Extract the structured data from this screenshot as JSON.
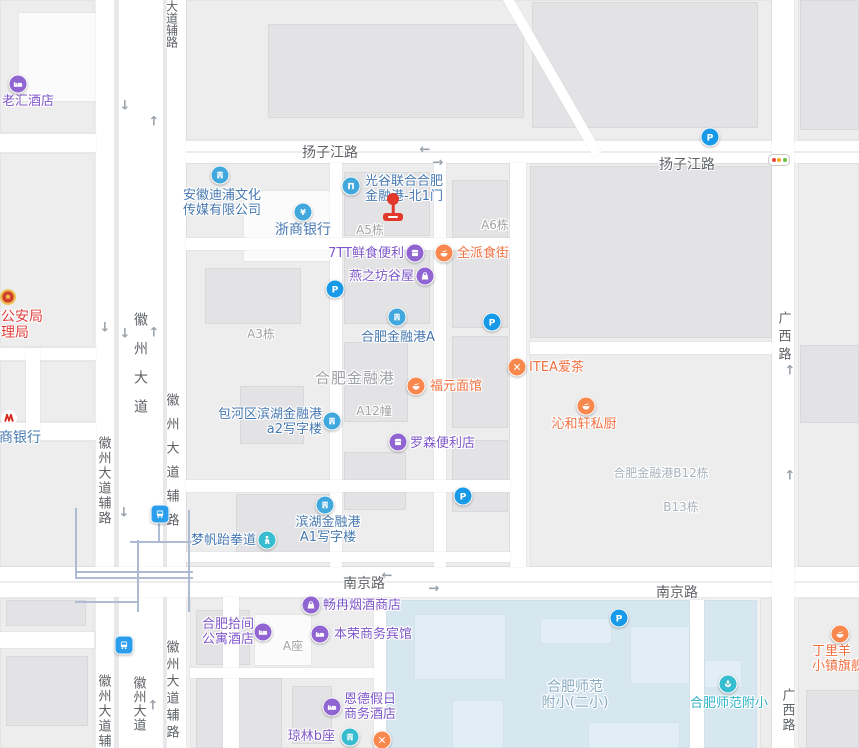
{
  "canvas": {
    "width": 859,
    "height": 748
  },
  "palette": {
    "purple": "#7e57c8",
    "purpleIcon": "#9065d2",
    "blue": "#4678b0",
    "blueIcon": "#41a8dd",
    "orange": "#ef7041",
    "orangeIcon": "#f8884e",
    "teal": "#2fb3c5",
    "tealIcon": "#38bccf",
    "red": "#e23d3c",
    "schoolarea": "#86aabf",
    "grayLabel": "#a2a2a4",
    "grayBig": "#9da0a4",
    "grayBlue": "#a9b1ba",
    "roadLabel": "#5f6266",
    "pIcon": "#199ae8",
    "busIcon": "#2a9ded",
    "marker": "#e2372b",
    "metro": "#aebcd3"
  },
  "road_labels": [
    {
      "text": "扬子江路",
      "x": 330,
      "y": 142
    },
    {
      "text": "扬子江路",
      "x": 687,
      "y": 154
    },
    {
      "text": "南京路",
      "x": 364,
      "y": 573
    },
    {
      "text": "南京路",
      "x": 677,
      "y": 582
    },
    {
      "text": "大道辅路",
      "x": 172,
      "y": 0,
      "v": 1,
      "size": 12,
      "spacing": 0
    },
    {
      "text": "徽州大道",
      "x": 140,
      "y": 312,
      "v": 1,
      "size": 14,
      "spacing": 15
    },
    {
      "text": "徽州大道辅路",
      "x": 171,
      "y": 393,
      "v": 1,
      "size": 13,
      "spacing": 11
    },
    {
      "text": "徽州大道辅路",
      "x": 103,
      "y": 436,
      "v": 1,
      "size": 13,
      "spacing": 2
    },
    {
      "text": "广西路",
      "x": 783,
      "y": 311,
      "v": 1,
      "size": 13,
      "spacing": 5
    },
    {
      "text": "广西路",
      "x": 787,
      "y": 688,
      "v": 1,
      "size": 13,
      "spacing": 2
    },
    {
      "text": "徽州大道辅路",
      "x": 103,
      "y": 674,
      "v": 1,
      "size": 13,
      "spacing": 2
    },
    {
      "text": "徽州大道",
      "x": 138,
      "y": 676,
      "v": 1,
      "size": 13,
      "spacing": 1
    },
    {
      "text": "徽州大道辅路",
      "x": 171,
      "y": 640,
      "v": 1,
      "size": 13,
      "spacing": 4
    }
  ],
  "area_labels": [
    {
      "text": "A5栋",
      "x": 370,
      "y": 221,
      "size": 12,
      "color": "grayLabel"
    },
    {
      "text": "A6栋",
      "x": 495,
      "y": 216,
      "size": 12,
      "color": "grayLabel"
    },
    {
      "text": "A3栋",
      "x": 261,
      "y": 325,
      "size": 12,
      "color": "grayLabel"
    },
    {
      "text": "A12幢",
      "x": 374,
      "y": 402,
      "size": 12,
      "color": "grayLabel"
    },
    {
      "text": "合肥金融港",
      "x": 355,
      "y": 367,
      "size": 15,
      "color": "grayBig",
      "ls": 1
    },
    {
      "text": "合肥金融港B12栋",
      "x": 661,
      "y": 464,
      "size": 12,
      "color": "grayBlue"
    },
    {
      "text": "B13栋",
      "x": 681,
      "y": 498,
      "size": 12,
      "color": "grayBlue"
    },
    {
      "text": "A座",
      "x": 293,
      "y": 637,
      "size": 12,
      "color": "grayLabel"
    }
  ],
  "pois": [
    {
      "slug": "laohui-hotel",
      "icon": {
        "type": "bed",
        "color": "purpleIcon",
        "x": 18,
        "y": 84
      },
      "label": {
        "lines": [
          "老汇酒店"
        ],
        "x": 2,
        "y": 94,
        "align": "left",
        "color": "purple",
        "size": 13
      }
    },
    {
      "slug": "police-bureau",
      "icon": {
        "type": "emblem",
        "color": "",
        "x": 8,
        "y": 297
      },
      "label": {
        "lines": [
          "市公安局",
          "管理局"
        ],
        "x": -13,
        "y": 309,
        "align": "left",
        "color": "red",
        "size": 14
      }
    },
    {
      "slug": "zhaoshang-bank",
      "icon": {
        "type": "mlogo",
        "color": "",
        "x": 9,
        "y": 418
      },
      "label": {
        "lines": [
          "商银行"
        ],
        "x": -1,
        "y": 430,
        "align": "left",
        "color": "blue",
        "size": 14
      }
    },
    {
      "slug": "anhui-dipu-media",
      "icon": {
        "type": "building",
        "color": "blueIcon",
        "x": 220,
        "y": 175
      },
      "label": {
        "lines": [
          "安徽迪浦文化",
          "传媒有限公司"
        ],
        "x": 222,
        "y": 188,
        "align": "center",
        "color": "blue",
        "size": 13
      }
    },
    {
      "slug": "zheshang-bank",
      "icon": {
        "type": "yen",
        "color": "blueIcon",
        "x": 303,
        "y": 212
      },
      "label": {
        "lines": [
          "浙商银行"
        ],
        "x": 303,
        "y": 222,
        "align": "center",
        "color": "blue",
        "size": 14
      }
    },
    {
      "slug": "guanggu-north-gate-1",
      "icon": {
        "type": "door",
        "color": "blueIcon",
        "x": 351,
        "y": 186
      },
      "label": {
        "lines": [
          "光谷联合合肥",
          "金融港-北1门"
        ],
        "x": 365,
        "y": 174,
        "align": "left",
        "color": "blue",
        "size": 13
      }
    },
    {
      "slug": "7tt-fresh-food",
      "icon": {
        "type": "store",
        "color": "purpleIcon",
        "x": 415,
        "y": 253
      },
      "label": {
        "lines": [
          "7TT鲜食便利"
        ],
        "x": 404,
        "y": 246,
        "align": "right",
        "color": "purple",
        "size": 13
      }
    },
    {
      "slug": "quanpai-food-street",
      "icon": {
        "type": "bowl",
        "color": "orangeIcon",
        "x": 444,
        "y": 253
      },
      "label": {
        "lines": [
          "全派食街"
        ],
        "x": 457,
        "y": 246,
        "align": "left",
        "color": "orange",
        "size": 13
      }
    },
    {
      "slug": "yanzhifang-guwu",
      "icon": {
        "type": "bag",
        "color": "purpleIcon",
        "x": 425,
        "y": 276
      },
      "label": {
        "lines": [
          "燕之坊谷屋"
        ],
        "x": 414,
        "y": 269,
        "align": "right",
        "color": "purple",
        "size": 13
      }
    },
    {
      "slug": "hefei-jinronggang-a",
      "icon": {
        "type": "building",
        "color": "blueIcon",
        "x": 397,
        "y": 317
      },
      "label": {
        "lines": [
          "合肥金融港A"
        ],
        "x": 398,
        "y": 330,
        "align": "center",
        "color": "blue",
        "size": 13
      }
    },
    {
      "slug": "fuyuan-noodle",
      "icon": {
        "type": "bowl",
        "color": "orangeIcon",
        "x": 416,
        "y": 386
      },
      "label": {
        "lines": [
          "福元面馆"
        ],
        "x": 430,
        "y": 379,
        "align": "left",
        "color": "orange",
        "size": 13
      }
    },
    {
      "slug": "itea-tea",
      "icon": {
        "type": "forkknife",
        "color": "orangeIcon",
        "x": 517,
        "y": 367
      },
      "label": {
        "lines": [
          "ITEA爱茶"
        ],
        "x": 529,
        "y": 360,
        "align": "left",
        "color": "orange",
        "size": 13
      }
    },
    {
      "slug": "qinhexuan-kitchen",
      "icon": {
        "type": "bowl",
        "color": "orangeIcon",
        "x": 586,
        "y": 406
      },
      "label": {
        "lines": [
          "沁和轩私厨"
        ],
        "x": 584,
        "y": 417,
        "align": "center",
        "color": "orange",
        "size": 13
      }
    },
    {
      "slug": "lawson-store",
      "icon": {
        "type": "store",
        "color": "purpleIcon",
        "x": 398,
        "y": 442
      },
      "label": {
        "lines": [
          "罗森便利店"
        ],
        "x": 410,
        "y": 436,
        "align": "left",
        "color": "purple",
        "size": 13
      }
    },
    {
      "slug": "a2-office-tower",
      "icon": {
        "type": "building",
        "color": "blueIcon",
        "x": 332,
        "y": 421
      },
      "label": {
        "lines": [
          "包河区滨湖金融港",
          "a2写字楼"
        ],
        "x": 322,
        "y": 407,
        "align": "right",
        "color": "blue",
        "size": 13
      }
    },
    {
      "slug": "a1-office-tower",
      "icon": {
        "type": "building",
        "color": "blueIcon",
        "x": 325,
        "y": 505
      },
      "label": {
        "lines": [
          "滨湖金融港",
          "A1写字楼"
        ],
        "x": 328,
        "y": 515,
        "align": "center",
        "color": "blue",
        "size": 13
      }
    },
    {
      "slug": "mengfan-taekwondo",
      "icon": {
        "type": "person",
        "color": "tealIcon",
        "x": 267,
        "y": 540
      },
      "label": {
        "lines": [
          "梦帆跆拳道"
        ],
        "x": 256,
        "y": 533,
        "align": "right",
        "color": "blue",
        "size": 13
      }
    },
    {
      "slug": "changran-tobacco-shop",
      "icon": {
        "type": "bag",
        "color": "purpleIcon",
        "x": 311,
        "y": 605
      },
      "label": {
        "lines": [
          "畅冉烟酒商店"
        ],
        "x": 323,
        "y": 598,
        "align": "left",
        "color": "purple",
        "size": 13
      }
    },
    {
      "slug": "hefei-shijian-apartment-hotel",
      "icon": {
        "type": "bed",
        "color": "purpleIcon",
        "x": 263,
        "y": 632
      },
      "label": {
        "lines": [
          "合肥拾间",
          "公寓酒店"
        ],
        "x": 254,
        "y": 617,
        "align": "right",
        "color": "purple",
        "size": 13
      }
    },
    {
      "slug": "benrong-business-hotel",
      "icon": {
        "type": "bed",
        "color": "purpleIcon",
        "x": 320,
        "y": 634
      },
      "label": {
        "lines": [
          "本荣商务宾馆"
        ],
        "x": 334,
        "y": 627,
        "align": "left",
        "color": "purple",
        "size": 13
      }
    },
    {
      "slug": "ende-holiday-hotel",
      "icon": {
        "type": "bed",
        "color": "purpleIcon",
        "x": 332,
        "y": 707
      },
      "label": {
        "lines": [
          "恩德假日",
          "商务酒店"
        ],
        "x": 344,
        "y": 692,
        "align": "left",
        "color": "purple",
        "size": 13
      }
    },
    {
      "slug": "qionglin-block-b",
      "icon": {
        "type": "building",
        "color": "tealIcon",
        "x": 350,
        "y": 737
      },
      "label": {
        "lines": [
          "琼林b座"
        ],
        "x": 335,
        "y": 729,
        "align": "right",
        "color": "purple",
        "size": 13
      }
    },
    {
      "slug": "restaurant-unnamed",
      "icon": {
        "type": "forkknife",
        "color": "orangeIcon",
        "x": 382,
        "y": 740
      },
      "label": null
    },
    {
      "slug": "shifan-fuxiao-ersiao-area",
      "icon": null,
      "label": {
        "lines": [
          "合肥师范",
          "附小(二小)"
        ],
        "x": 575,
        "y": 679,
        "align": "center",
        "color": "schoolarea",
        "size": 14
      }
    },
    {
      "slug": "hefei-shifan-fuxiao",
      "icon": {
        "type": "leaf",
        "color": "tealIcon",
        "x": 728,
        "y": 684
      },
      "label": {
        "lines": [
          "合肥师范附小"
        ],
        "x": 729,
        "y": 696,
        "align": "center",
        "color": "teal",
        "size": 13
      }
    },
    {
      "slug": "dingliyang-flagship",
      "icon": {
        "type": "bowl",
        "color": "orangeIcon",
        "x": 840,
        "y": 634
      },
      "label": {
        "lines": [
          "丁里羊",
          "小镇旗舰"
        ],
        "x": 812,
        "y": 644,
        "align": "left",
        "color": "orange",
        "size": 13
      }
    }
  ],
  "badges": {
    "parking": [
      {
        "x": 710,
        "y": 137
      },
      {
        "x": 335,
        "y": 289
      },
      {
        "x": 492,
        "y": 322
      },
      {
        "x": 463,
        "y": 496
      },
      {
        "x": 619,
        "y": 618
      }
    ],
    "bus": [
      {
        "x": 160,
        "y": 514
      },
      {
        "x": 124,
        "y": 645
      }
    ]
  },
  "traffic_light": {
    "x": 779,
    "y": 160
  },
  "gate_marker": {
    "x": 393,
    "dot_y": 199,
    "bar_y": 217
  },
  "arrows": [
    {
      "x": 125,
      "y": 106,
      "g": "↓"
    },
    {
      "x": 154,
      "y": 122,
      "g": "↑"
    },
    {
      "x": 105,
      "y": 328,
      "g": "↓"
    },
    {
      "x": 125,
      "y": 334,
      "g": "↓"
    },
    {
      "x": 154,
      "y": 333,
      "g": "↑"
    },
    {
      "x": 425,
      "y": 150,
      "g": "←"
    },
    {
      "x": 438,
      "y": 163,
      "g": "→"
    },
    {
      "x": 387,
      "y": 576,
      "g": "←"
    },
    {
      "x": 434,
      "y": 589,
      "g": "→"
    },
    {
      "x": 790,
      "y": 371,
      "g": "↑"
    },
    {
      "x": 790,
      "y": 476,
      "g": "↑"
    },
    {
      "x": 153,
      "y": 706,
      "g": "↑"
    },
    {
      "x": 124,
      "y": 513,
      "g": "↓"
    }
  ]
}
